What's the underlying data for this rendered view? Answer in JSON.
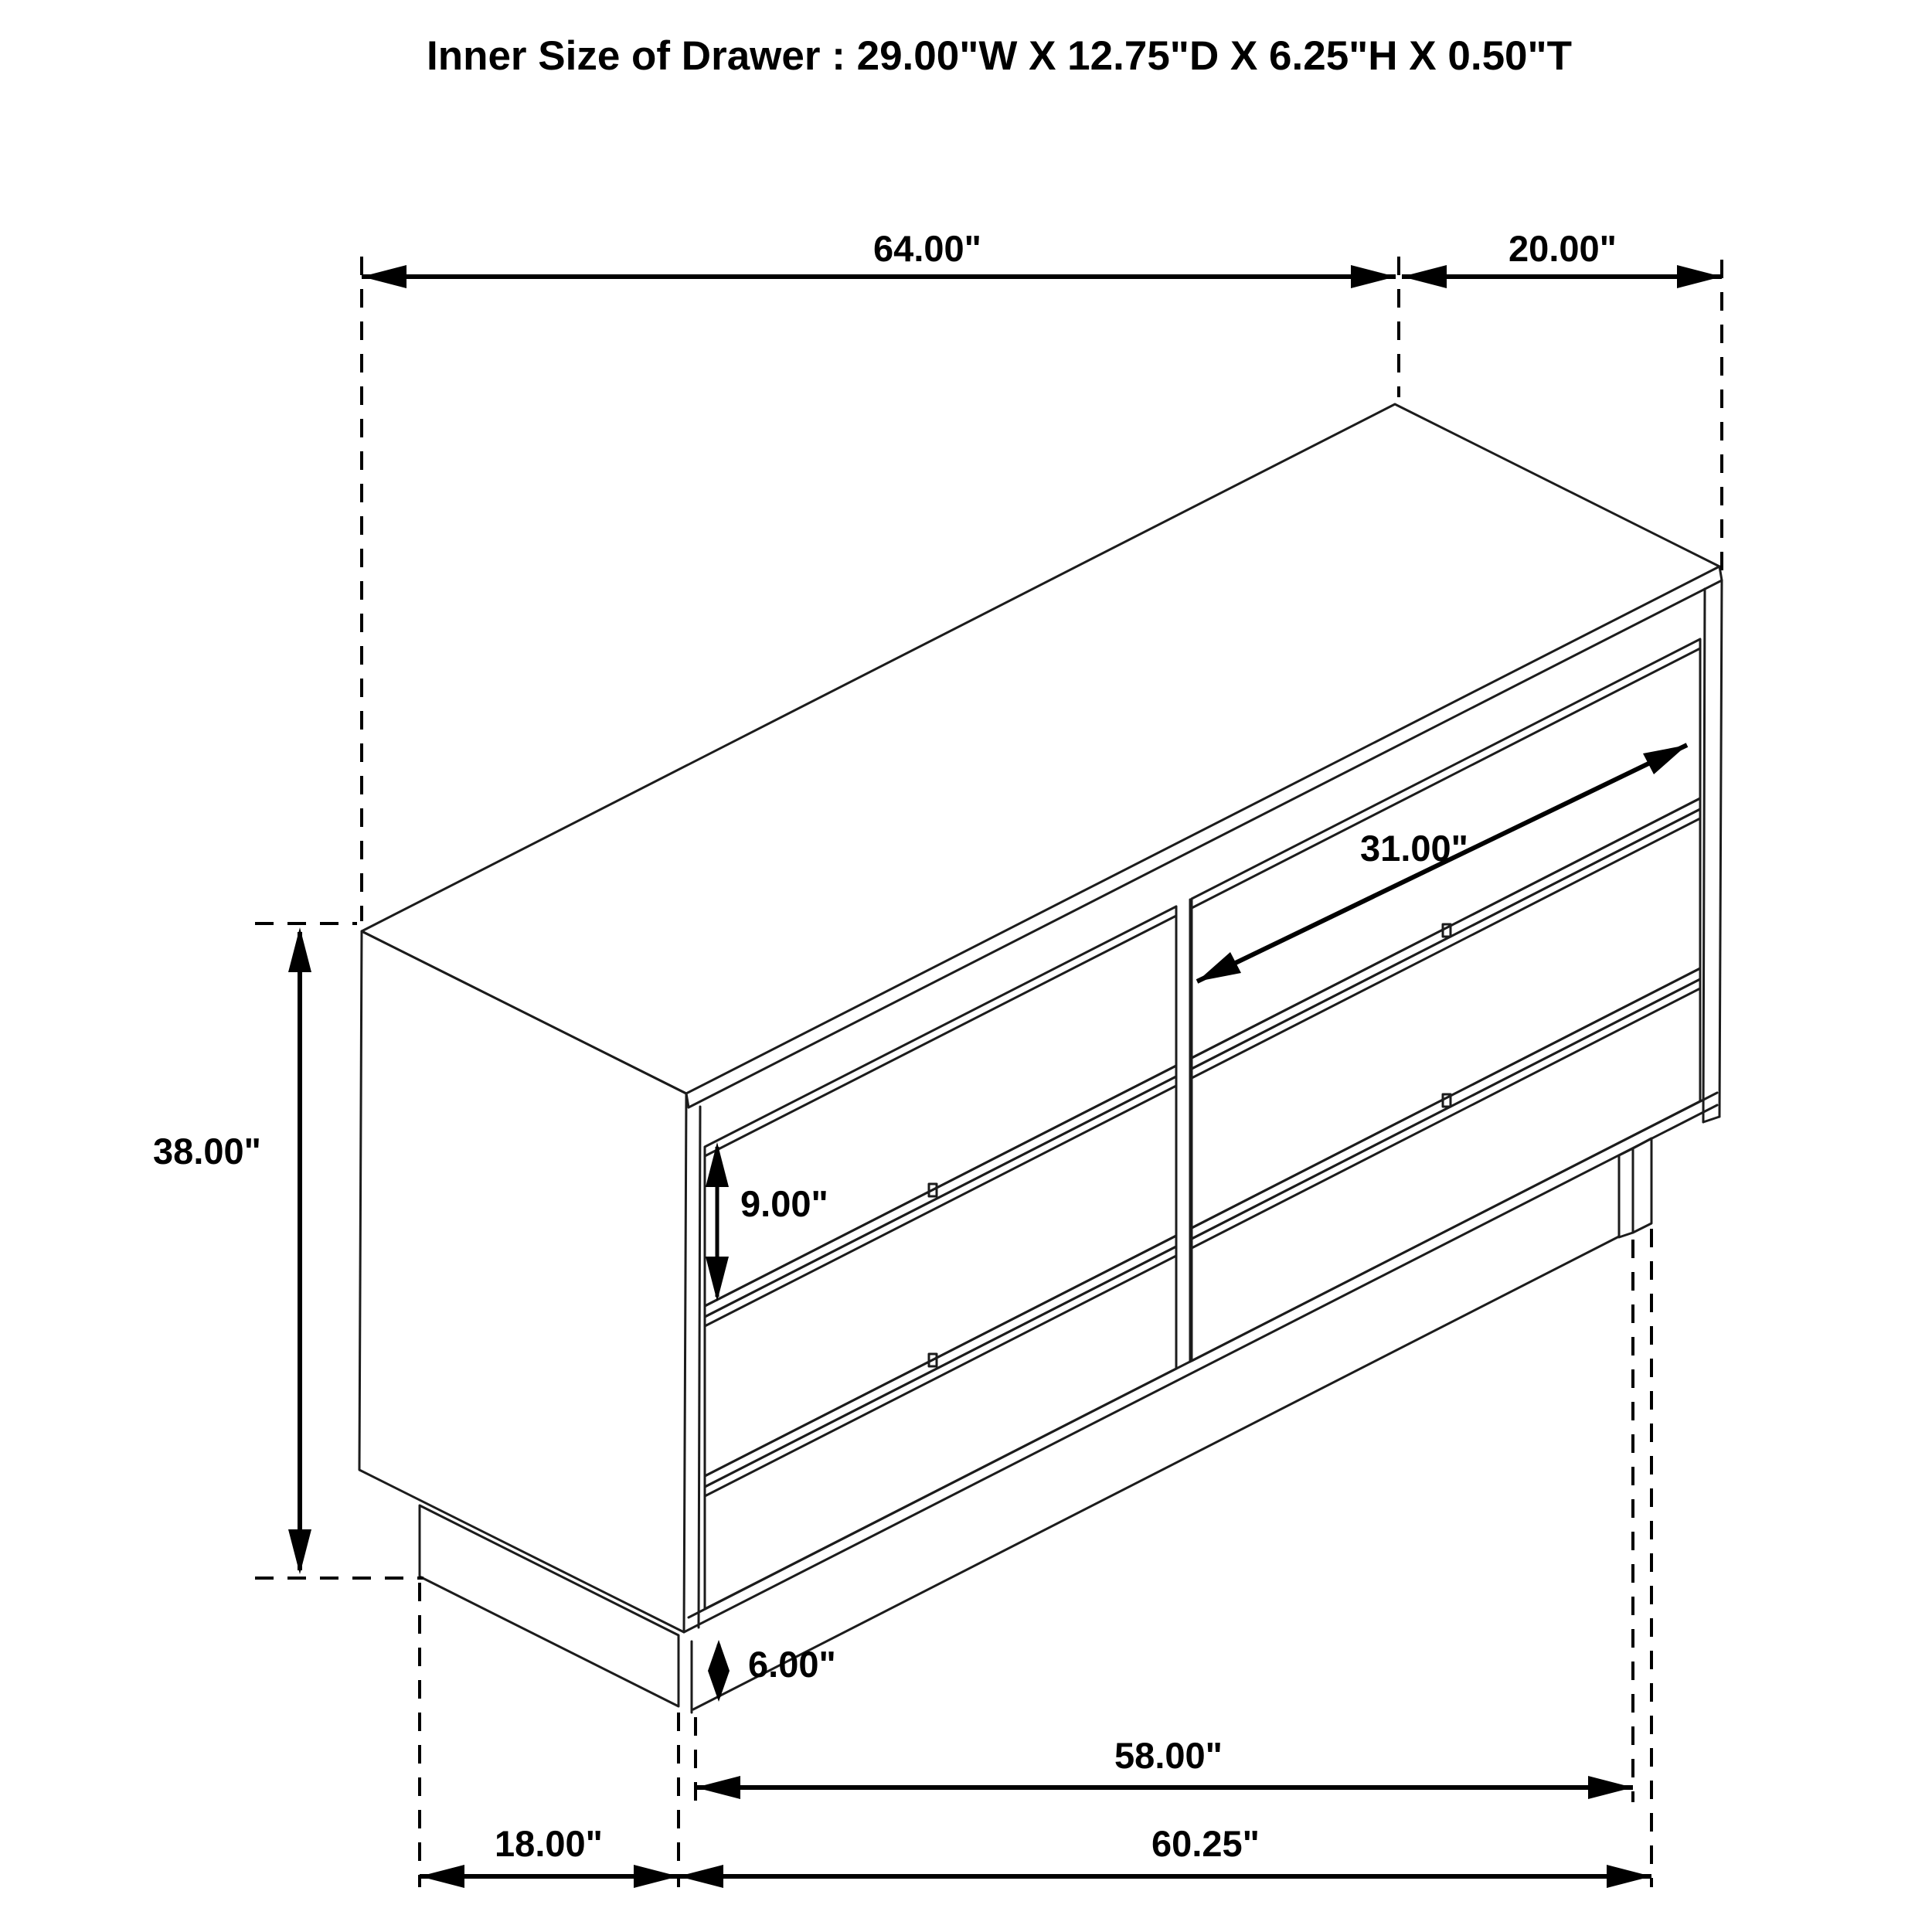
{
  "title": "Inner Size of Drawer : 29.00\"W X 12.75\"D X 6.25\"H X 0.50\"T",
  "figure": {
    "type": "isometric-furniture-dimension-diagram",
    "subject": "6-drawer dresser",
    "colors": {
      "line": "#1c1c1c",
      "dimension": "#000000",
      "background": "#ffffff"
    }
  },
  "dimensions": {
    "overall_width": {
      "label": "64.00\""
    },
    "top_depth": {
      "label": "20.00\""
    },
    "drawer_diagonal_width": {
      "label": "31.00\""
    },
    "drawer_front_height": {
      "label": "9.00\""
    },
    "overall_height": {
      "label": "38.00\""
    },
    "base_height": {
      "label": "6.00\""
    },
    "base_inner_width": {
      "label": "58.00\""
    },
    "base_outer_width": {
      "label": "60.25\""
    },
    "base_depth": {
      "label": "18.00\""
    }
  }
}
